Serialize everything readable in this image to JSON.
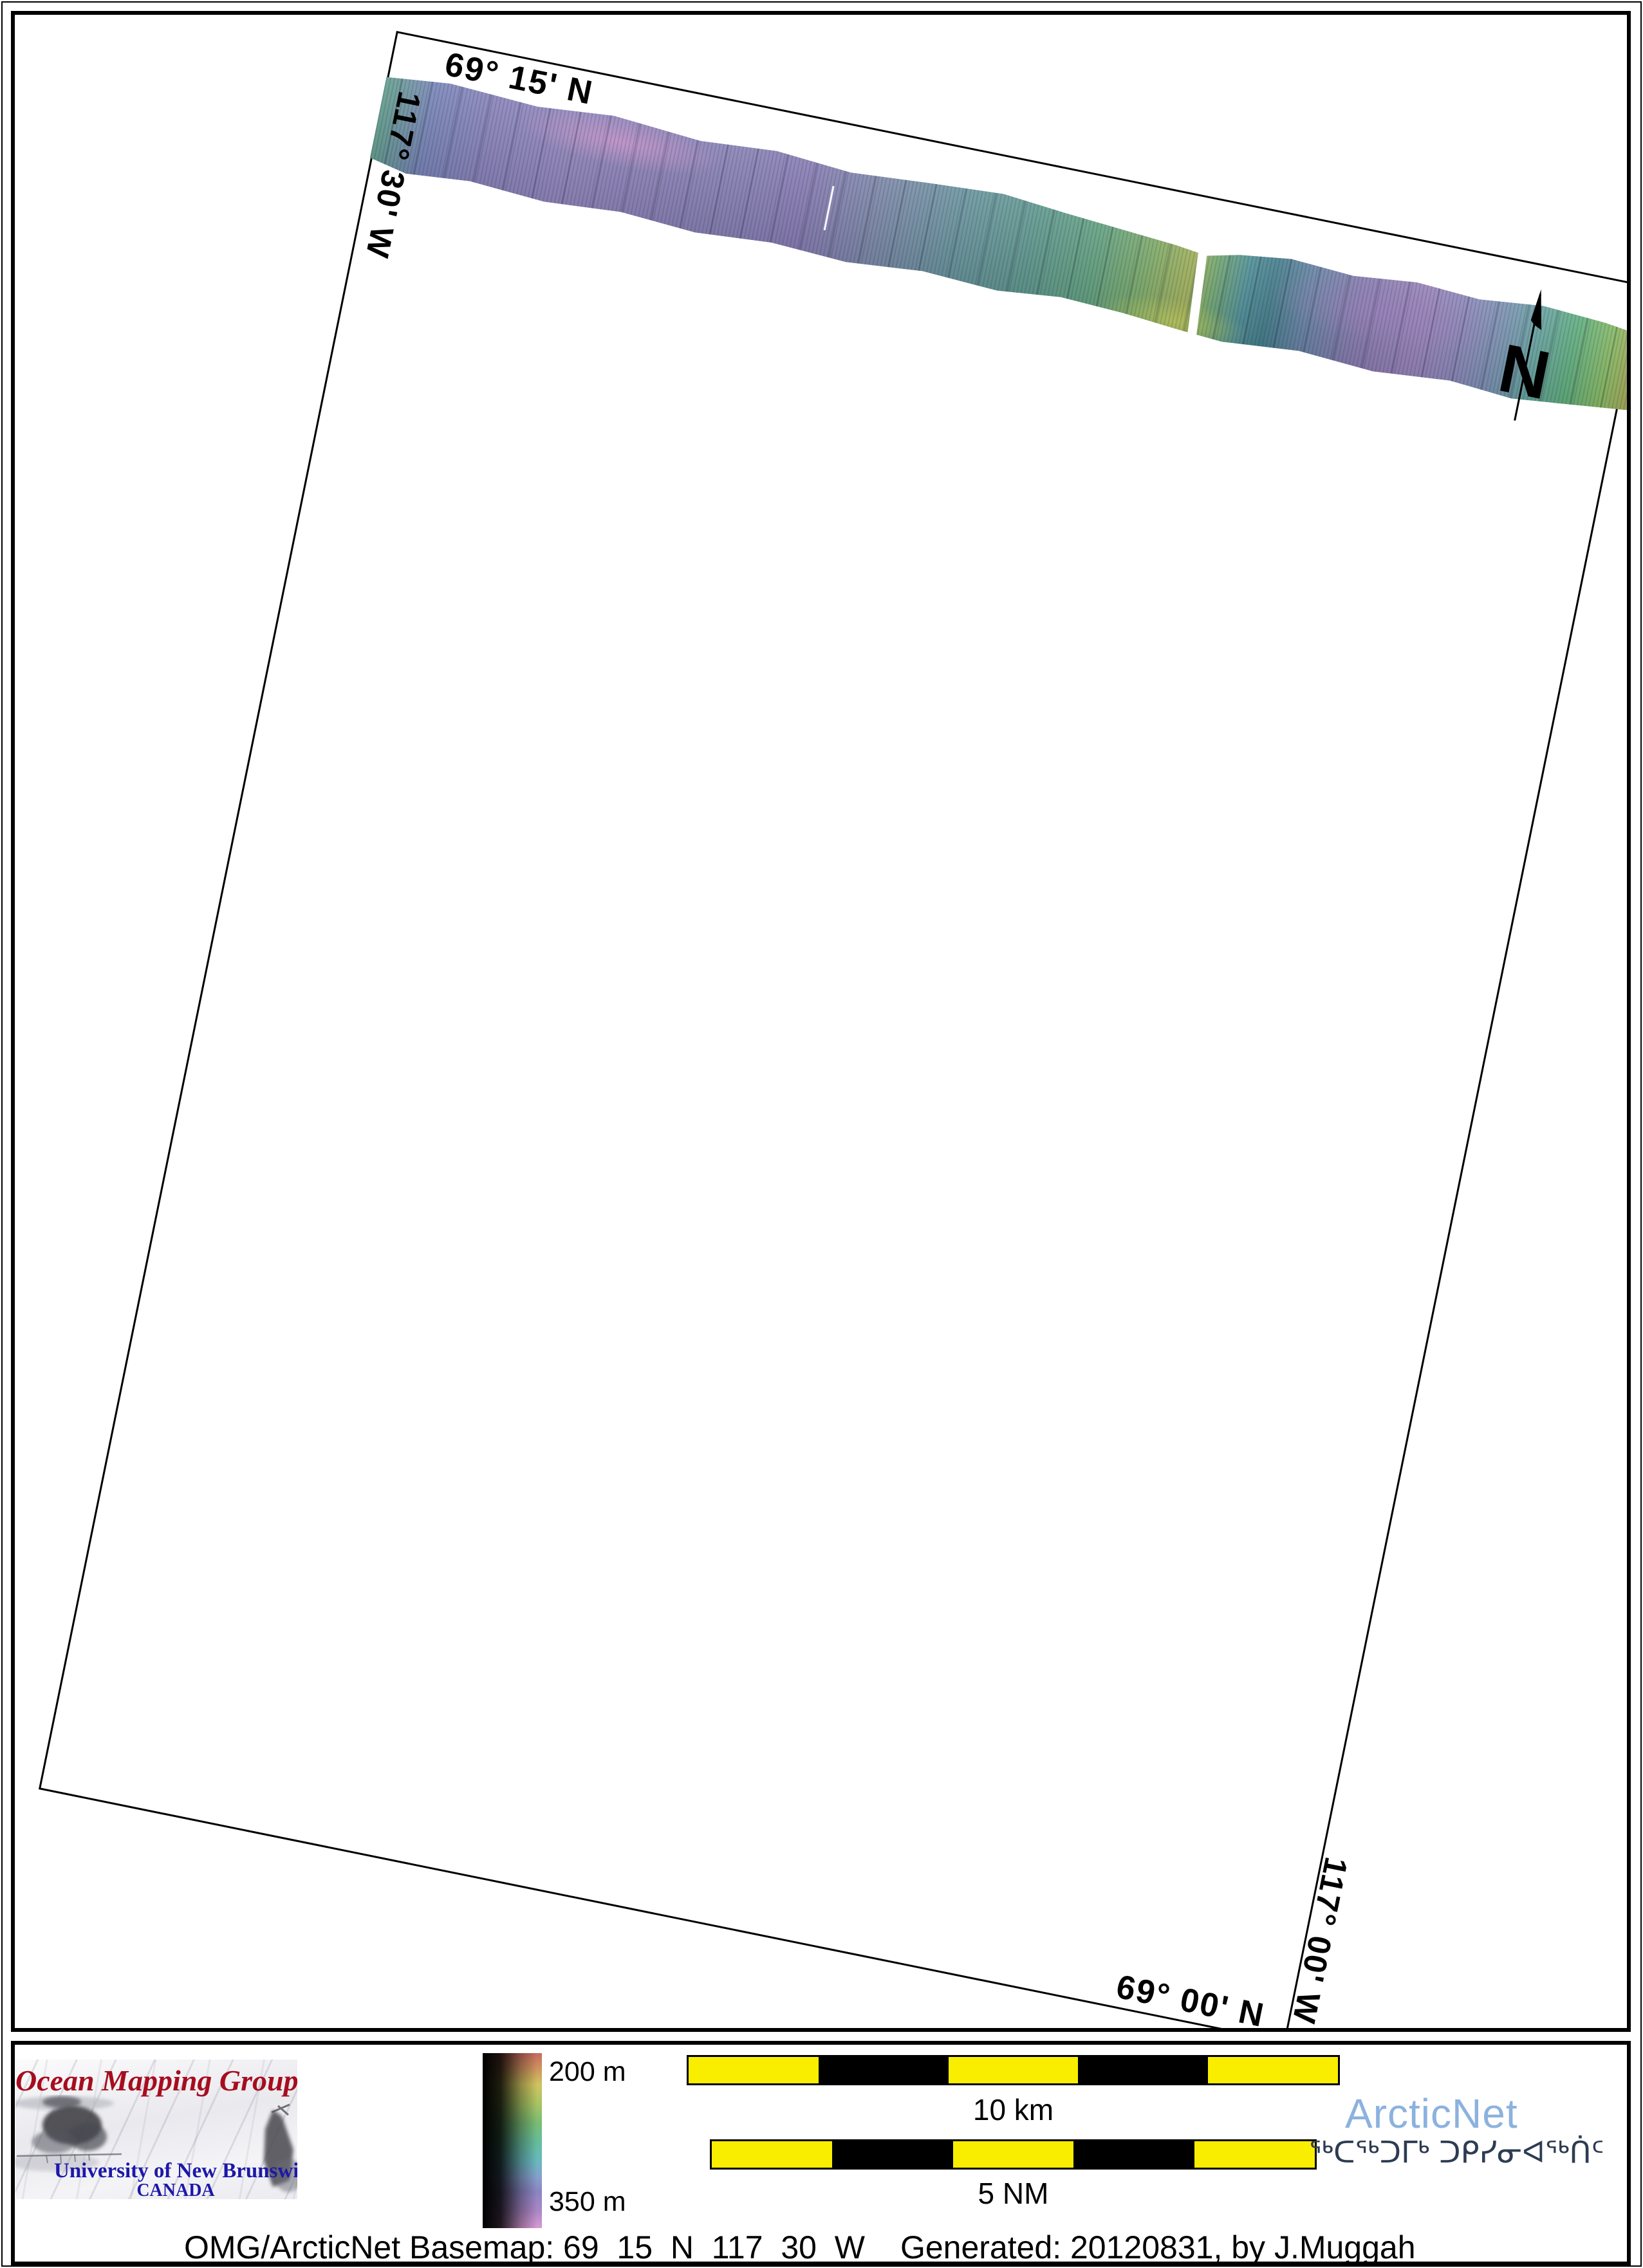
{
  "map": {
    "grid_labels": {
      "top": "69° 15' N",
      "left": "117° 30' W",
      "bottom": "69° 00' N",
      "right": "117° 00' W"
    },
    "north_label": "N"
  },
  "legend": {
    "omg_logo": {
      "title": "Ocean Mapping Group",
      "subtitle": "University of New Brunswick",
      "country": "CANADA"
    },
    "colorbar": {
      "top_label": "200 m",
      "bottom_label": "350 m",
      "top_depth_color": "#c96a5f",
      "bottom_depth_color": "#d79ad2"
    },
    "scalebars": [
      {
        "label": "10 km"
      },
      {
        "label": "5 NM"
      }
    ],
    "arcticnet": {
      "name": "ArcticNet",
      "syllabics": "ᖅᑕᖅᑐᒥᒃ ᑐᑭᓯᓂᐊᖅᑏᑦ"
    }
  },
  "footer_text": {
    "basemap": "OMG/ArcticNet Basemap: 69_15_N_117_30_W",
    "generated": "Generated: 20120831, by J.Muggah"
  },
  "colors": {
    "omg_red": "#a60d1f",
    "unb_blue": "#1d18a8",
    "arcticnet_blue": "#8cb2de",
    "syllabics_navy": "#2e3c52",
    "scalebar_yellow": "#f9ee00",
    "swath_purple": "#8a7fb6",
    "swath_teal": "#629b91",
    "swath_green": "#61b07f"
  }
}
